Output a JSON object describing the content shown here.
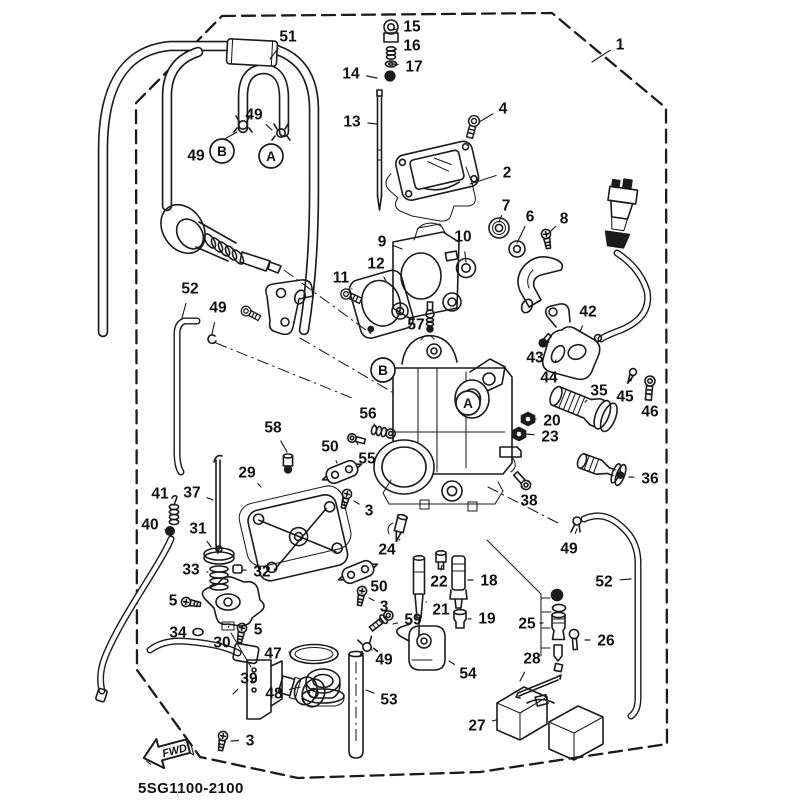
{
  "diagram": {
    "title_code": "5SG1100-2100",
    "fwd_label": "FWD",
    "colors": {
      "ink": "#1b1b1b",
      "paper": "#ffffff"
    },
    "callouts": [
      {
        "label": "1",
        "x": 620,
        "y": 44,
        "tx": 592,
        "ty": 62
      },
      {
        "label": "51",
        "x": 288,
        "y": 36,
        "tx": 270,
        "ty": 59
      },
      {
        "label": "49",
        "x": 254,
        "y": 114,
        "tx": 272,
        "ty": 130
      },
      {
        "label": "49",
        "x": 196,
        "y": 155,
        "tx": 237,
        "ty": 132
      },
      {
        "label": "15",
        "x": 412,
        "y": 26,
        "tx": 392,
        "ty": 30
      },
      {
        "label": "16",
        "x": 412,
        "y": 45,
        "tx": 393,
        "ty": 50
      },
      {
        "label": "17",
        "x": 414,
        "y": 66,
        "tx": 393,
        "ty": 64
      },
      {
        "label": "14",
        "x": 351,
        "y": 73,
        "tx": 377,
        "ty": 78
      },
      {
        "label": "13",
        "x": 352,
        "y": 121,
        "tx": 377,
        "ty": 124
      },
      {
        "label": "4",
        "x": 503,
        "y": 108,
        "tx": 479,
        "ty": 122
      },
      {
        "label": "2",
        "x": 507,
        "y": 172,
        "tx": 470,
        "ty": 184
      },
      {
        "label": "7",
        "x": 506,
        "y": 205,
        "tx": 499,
        "ty": 222
      },
      {
        "label": "6",
        "x": 530,
        "y": 216,
        "tx": 517,
        "ty": 243
      },
      {
        "label": "8",
        "x": 564,
        "y": 218,
        "tx": 546,
        "ty": 236
      },
      {
        "label": "9",
        "x": 382,
        "y": 241,
        "tx": 402,
        "ty": 249
      },
      {
        "label": "10",
        "x": 463,
        "y": 236,
        "tx": 466,
        "ty": 262
      },
      {
        "label": "12",
        "x": 376,
        "y": 263,
        "tx": 386,
        "ty": 281
      },
      {
        "label": "11",
        "x": 341,
        "y": 277,
        "tx": 352,
        "ty": 289
      },
      {
        "label": "57",
        "x": 416,
        "y": 324,
        "tx": 427,
        "ty": 322
      },
      {
        "label": "52",
        "x": 190,
        "y": 288,
        "tx": 182,
        "ty": 318
      },
      {
        "label": "49",
        "x": 218,
        "y": 307,
        "tx": 212,
        "ty": 334
      },
      {
        "label": "42",
        "x": 588,
        "y": 311,
        "tx": 580,
        "ty": 332
      },
      {
        "label": "43",
        "x": 535,
        "y": 357,
        "tx": 542,
        "ty": 346
      },
      {
        "label": "44",
        "x": 549,
        "y": 377,
        "tx": 556,
        "ty": 360
      },
      {
        "label": "45",
        "x": 625,
        "y": 396,
        "tx": 632,
        "ty": 378
      },
      {
        "label": "46",
        "x": 650,
        "y": 411,
        "tx": 650,
        "ty": 394
      },
      {
        "label": "35",
        "x": 599,
        "y": 390,
        "tx": 585,
        "ty": 402
      },
      {
        "label": "20",
        "x": 552,
        "y": 420,
        "tx": 535,
        "ty": 419
      },
      {
        "label": "23",
        "x": 550,
        "y": 436,
        "tx": 526,
        "ty": 434
      },
      {
        "label": "36",
        "x": 650,
        "y": 478,
        "tx": 629,
        "ty": 477
      },
      {
        "label": "56",
        "x": 368,
        "y": 413,
        "tx": 374,
        "ty": 424
      },
      {
        "label": "58",
        "x": 273,
        "y": 427,
        "tx": 287,
        "ty": 452
      },
      {
        "label": "50",
        "x": 330,
        "y": 446,
        "tx": 337,
        "ty": 463
      },
      {
        "label": "55",
        "x": 367,
        "y": 458,
        "tx": 357,
        "ty": 443
      },
      {
        "label": "29",
        "x": 247,
        "y": 472,
        "tx": 261,
        "ty": 487
      },
      {
        "label": "41",
        "x": 160,
        "y": 493,
        "tx": 171,
        "ty": 504
      },
      {
        "label": "37",
        "x": 192,
        "y": 492,
        "tx": 213,
        "ty": 500
      },
      {
        "label": "40",
        "x": 150,
        "y": 524,
        "tx": 165,
        "ty": 530
      },
      {
        "label": "31",
        "x": 198,
        "y": 528,
        "tx": 211,
        "ty": 547
      },
      {
        "label": "33",
        "x": 191,
        "y": 569,
        "tx": 208,
        "ty": 572
      },
      {
        "label": "32",
        "x": 262,
        "y": 571,
        "tx": 243,
        "ty": 570
      },
      {
        "label": "5",
        "x": 173,
        "y": 600,
        "tx": 184,
        "ty": 602
      },
      {
        "label": "34",
        "x": 178,
        "y": 632,
        "tx": 194,
        "ty": 632
      },
      {
        "label": "30",
        "x": 222,
        "y": 642,
        "tx": 229,
        "ty": 626
      },
      {
        "label": "5",
        "x": 258,
        "y": 629,
        "tx": 246,
        "ty": 630
      },
      {
        "label": "3",
        "x": 369,
        "y": 510,
        "tx": 354,
        "ty": 501
      },
      {
        "label": "24",
        "x": 387,
        "y": 549,
        "tx": 399,
        "ty": 540
      },
      {
        "label": "50",
        "x": 379,
        "y": 586,
        "tx": 365,
        "ty": 578
      },
      {
        "label": "3",
        "x": 384,
        "y": 606,
        "tx": 369,
        "ty": 598
      },
      {
        "label": "59",
        "x": 413,
        "y": 619,
        "tx": 393,
        "ty": 624
      },
      {
        "label": "38",
        "x": 529,
        "y": 500,
        "tx": 522,
        "ty": 488
      },
      {
        "label": "49",
        "x": 569,
        "y": 548,
        "tx": 577,
        "ty": 529
      },
      {
        "label": "22",
        "x": 439,
        "y": 581,
        "tx": 441,
        "ty": 570
      },
      {
        "label": "18",
        "x": 489,
        "y": 580,
        "tx": 468,
        "ty": 580
      },
      {
        "label": "21",
        "x": 441,
        "y": 609,
        "tx": 426,
        "ty": 602
      },
      {
        "label": "19",
        "x": 487,
        "y": 618,
        "tx": 468,
        "ty": 619
      },
      {
        "label": "25",
        "x": 527,
        "y": 623,
        "tx": 540,
        "ty": 623
      },
      {
        "label": "26",
        "x": 606,
        "y": 640,
        "tx": 585,
        "ty": 640
      },
      {
        "label": "28",
        "x": 532,
        "y": 658,
        "tx": 520,
        "ty": 681
      },
      {
        "label": "27",
        "x": 477,
        "y": 725,
        "tx": 496,
        "ty": 720
      },
      {
        "label": "52",
        "x": 604,
        "y": 581,
        "tx": 631,
        "ty": 579
      },
      {
        "label": "54",
        "x": 468,
        "y": 673,
        "tx": 449,
        "ty": 661
      },
      {
        "label": "49",
        "x": 384,
        "y": 659,
        "tx": 372,
        "ty": 650
      },
      {
        "label": "53",
        "x": 389,
        "y": 699,
        "tx": 366,
        "ty": 690
      },
      {
        "label": "47",
        "x": 273,
        "y": 653,
        "tx": 291,
        "ty": 652
      },
      {
        "label": "48",
        "x": 274,
        "y": 693,
        "tx": 300,
        "ty": 687
      },
      {
        "label": "39",
        "x": 249,
        "y": 678,
        "tx": 233,
        "ty": 694
      },
      {
        "label": "3",
        "x": 250,
        "y": 740,
        "tx": 231,
        "ty": 741
      }
    ],
    "markers": [
      {
        "label": "B",
        "x": 222,
        "y": 151
      },
      {
        "label": "A",
        "x": 271,
        "y": 156
      },
      {
        "label": "B",
        "x": 383,
        "y": 370
      },
      {
        "label": "A",
        "x": 468,
        "y": 403
      }
    ]
  }
}
